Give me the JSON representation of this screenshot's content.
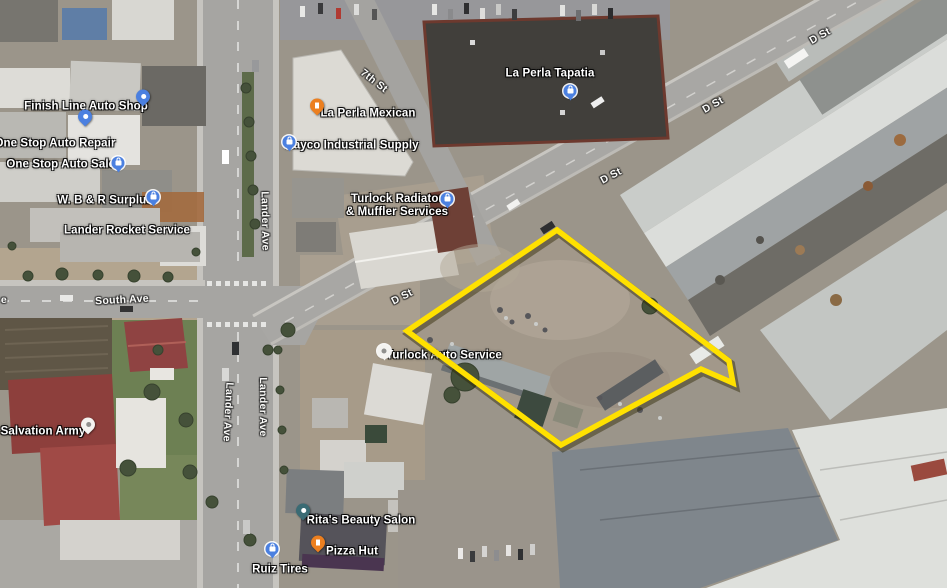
{
  "map": {
    "view": "satellite-aerial",
    "colors": {
      "parcel_outline": "#ffe100",
      "pin_blue": "#4b80e0",
      "pin_orange": "#ec7f1f",
      "pin_teal": "#3a6b74",
      "pin_white": "#f4f3f0"
    },
    "streets": [
      {
        "label": "7th St",
        "x": 374,
        "y": 81,
        "rotation": 38
      },
      {
        "label": "Lander Ave",
        "x": 265,
        "y": 221,
        "rotation": 89
      },
      {
        "label": "Lander Ave",
        "x": 228,
        "y": 412,
        "rotation": 93
      },
      {
        "label": "Lander Ave",
        "x": 263,
        "y": 407,
        "rotation": 90
      },
      {
        "label": "South Ave",
        "x": 122,
        "y": 300,
        "rotation": -3
      },
      {
        "label": "D St",
        "x": 402,
        "y": 297,
        "rotation": -27
      },
      {
        "label": "D St",
        "x": 611,
        "y": 176,
        "rotation": -28
      },
      {
        "label": "D St",
        "x": 713,
        "y": 105,
        "rotation": -30
      },
      {
        "label": "D St",
        "x": 820,
        "y": 36,
        "rotation": -30
      },
      {
        "label": "e",
        "x": 4,
        "y": 300,
        "rotation": 0
      }
    ],
    "places": [
      {
        "label": "Finish Line Auto Shop",
        "x": 86,
        "y": 107,
        "pin": {
          "shape": "teardrop",
          "color": "pin_blue",
          "glyph": "wrench-icon",
          "x": 143,
          "y": 101
        }
      },
      {
        "label": "One Stop Auto Repair",
        "x": 55,
        "y": 144,
        "pin": {
          "shape": "teardrop",
          "color": "pin_blue",
          "glyph": "wrench-icon",
          "x": 85,
          "y": 121
        }
      },
      {
        "label": "One Stop Auto Sales",
        "x": 64,
        "y": 165,
        "pin": {
          "shape": "circle",
          "color": "pin_blue",
          "glyph": "bag-icon",
          "x": 118,
          "y": 164
        }
      },
      {
        "label": "W. B & R Surplus",
        "x": 105,
        "y": 201,
        "pin": {
          "shape": "circle",
          "color": "pin_blue",
          "glyph": "bag-icon",
          "x": 153,
          "y": 198
        }
      },
      {
        "label": "Lander Rocket Service",
        "x": 127,
        "y": 231,
        "pin": null
      },
      {
        "label": "La Perla Mexican",
        "x": 368,
        "y": 114,
        "pin": {
          "shape": "teardrop",
          "color": "pin_orange",
          "glyph": "restaurant-icon",
          "x": 317,
          "y": 110
        }
      },
      {
        "label": "Rayco Industrial Supply",
        "x": 352,
        "y": 146,
        "pin": {
          "shape": "circle",
          "color": "pin_blue",
          "glyph": "briefcase-icon",
          "x": 289,
          "y": 143
        }
      },
      {
        "label": "La Perla Tapatia",
        "x": 550,
        "y": 74,
        "pin": {
          "shape": "circle",
          "color": "pin_blue",
          "glyph": "cart-icon",
          "x": 570,
          "y": 92
        }
      },
      {
        "lines": [
          "Turlock Radiator",
          "& Muffler Services"
        ],
        "x": 397,
        "y": 206,
        "pin": {
          "shape": "circle",
          "color": "pin_blue",
          "glyph": "briefcase-icon",
          "x": 447,
          "y": 200
        }
      },
      {
        "label": "Turlock Auto Service",
        "x": 444,
        "y": 356,
        "pin": {
          "shape": "circle",
          "color": "pin_white",
          "glyph": "dot-icon",
          "x": 384,
          "y": 352
        }
      },
      {
        "label": "Salvation Army",
        "x": 43,
        "y": 432,
        "pin": {
          "shape": "teardrop",
          "color": "pin_white",
          "glyph": "dot-icon",
          "x": 88,
          "y": 429
        }
      },
      {
        "label": "Rita's Beauty Salon",
        "x": 361,
        "y": 521,
        "pin": {
          "shape": "teardrop",
          "color": "pin_teal",
          "glyph": "dot-icon",
          "x": 303,
          "y": 515
        }
      },
      {
        "label": "Pizza Hut",
        "x": 352,
        "y": 552,
        "pin": {
          "shape": "teardrop",
          "color": "pin_orange",
          "glyph": "restaurant-icon",
          "x": 318,
          "y": 547
        }
      },
      {
        "label": "Ruiz Tires",
        "x": 280,
        "y": 570,
        "pin": {
          "shape": "circle",
          "color": "pin_blue",
          "glyph": "briefcase-icon",
          "x": 272,
          "y": 550
        }
      }
    ],
    "parcel_outline": {
      "color": "#ffe100",
      "points": "557,230 729,361 733,383 701,369 561,445 407,331"
    }
  }
}
